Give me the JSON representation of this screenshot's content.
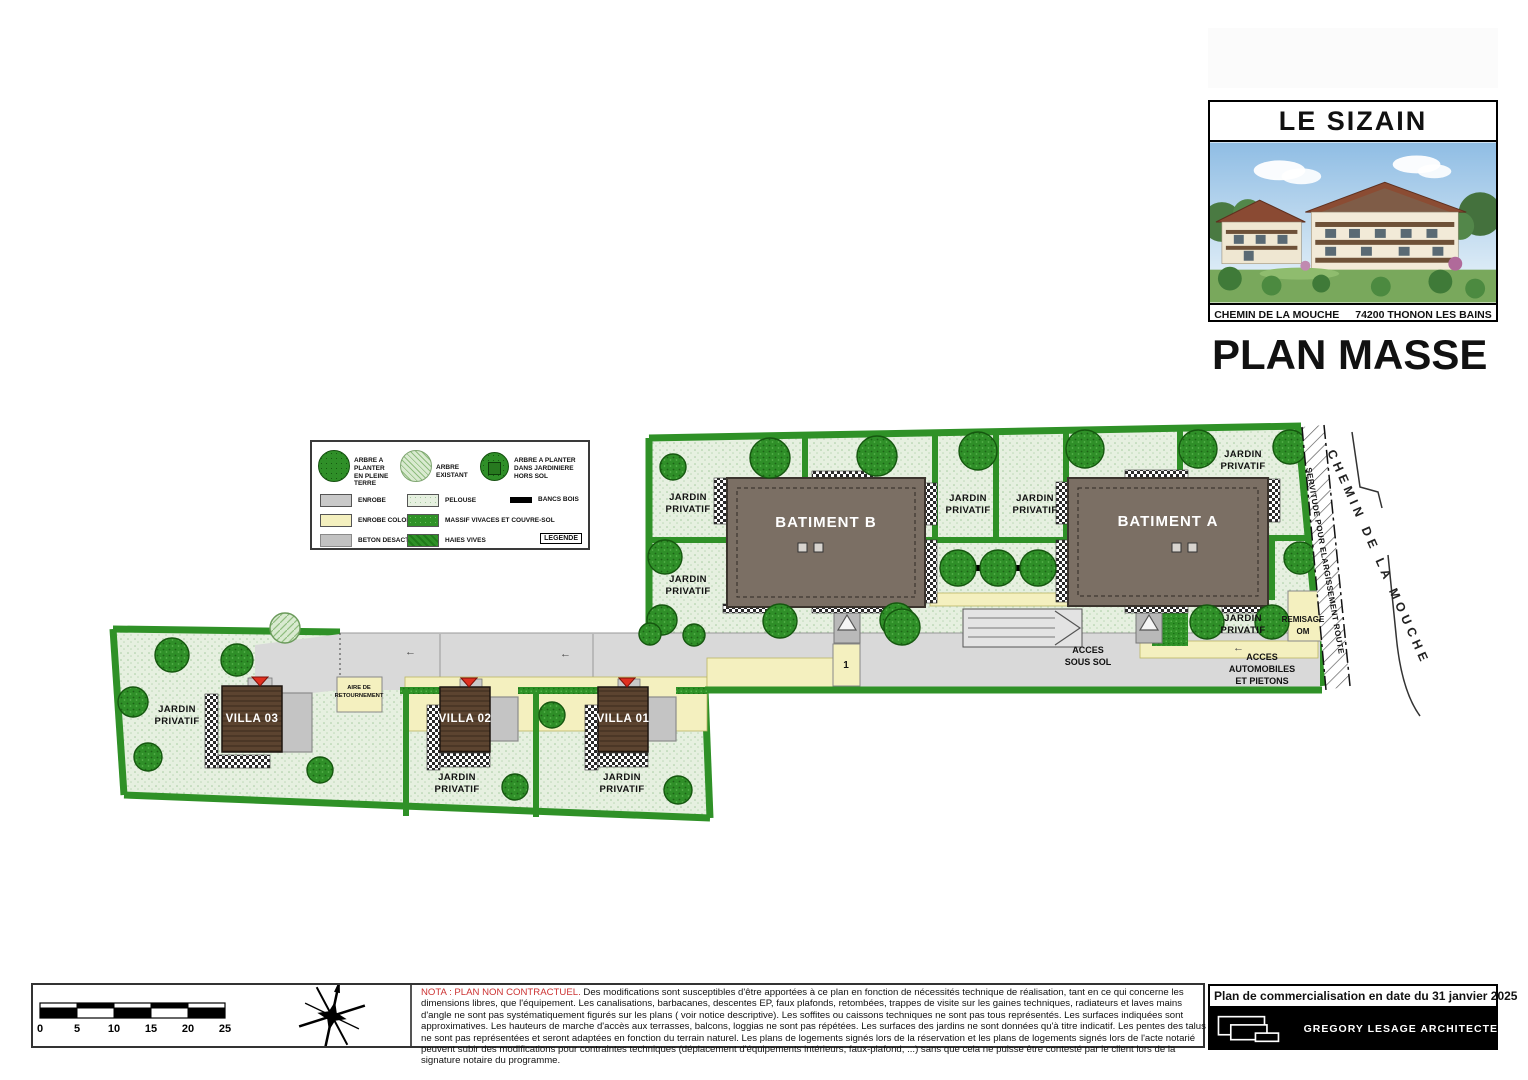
{
  "header": {
    "project_title": "LE SIZAIN",
    "address_street": "CHEMIN DE LA MOUCHE",
    "address_city": "74200 THONON LES BAINS",
    "drawing_title": "PLAN MASSE"
  },
  "legend": {
    "title": "LEGENDE",
    "tree_items": [
      {
        "line1": "ARBRE A PLANTER",
        "line2": "EN PLEINE TERRE"
      },
      {
        "line1": "ARBRE EXISTANT",
        "line2": ""
      },
      {
        "line1": "ARBRE A PLANTER",
        "line2": "DANS JARDINIERE HORS SOL"
      }
    ],
    "surface_items": [
      {
        "label": "ENROBE"
      },
      {
        "label": "ENROBE COLORE"
      },
      {
        "label": "BETON DESACTIVE"
      },
      {
        "label": "PELOUSE"
      },
      {
        "label": "MASSIF VIVACES ET COUVRE-SOL"
      },
      {
        "label": "HAIES VIVES"
      },
      {
        "label": "BANCS BOIS"
      }
    ]
  },
  "plan": {
    "batiment_a": "BATIMENT A",
    "batiment_b": "BATIMENT B",
    "villa_01": "VILLA 01",
    "villa_02": "VILLA 02",
    "villa_03": "VILLA 03",
    "jardin_l1": "JARDIN",
    "jardin_l2": "PRIVATIF",
    "acces_sous_sol_l1": "ACCES",
    "acces_sous_sol_l2": "SOUS SOL",
    "acces_auto_l1": "ACCES",
    "acces_auto_l2": "AUTOMOBILES",
    "acces_auto_l3": "ET PIETONS",
    "remisage_l1": "REMISAGE",
    "remisage_l2": "OM",
    "aire_l1": "AIRE DE",
    "aire_l2": "RETOURNEMENT",
    "servitude": "SERVITUDE POUR ELARGISSEMENT ROUTE",
    "road_name": "CHEMIN DE LA MOUCHE",
    "parking_spot": "1"
  },
  "scale_bar": {
    "labels": [
      "0",
      "5",
      "10",
      "15",
      "20",
      "25"
    ]
  },
  "nota": {
    "warning": "NOTA : PLAN NON CONTRACTUEL.",
    "body": "Des modifications sont susceptibles d'être apportées à ce plan en fonction de nécessités technique de réalisation, tant en ce qui concerne les dimensions libres, que l'équipement. Les canalisations, barbacanes, descentes EP, faux plafonds, retombées, trappes de visite sur les gaines techniques, radiateurs et laves mains d'angle ne sont pas systématiquement figurés sur les plans ( voir notice descriptive). Les soffites ou caissons techniques ne sont pas tous représentés. Les surfaces indiquées sont approximatives. Les hauteurs de marche d'accès aux terrasses, balcons, loggias ne sont pas répétées. Les surfaces des jardins ne sont données qu'à titre indicatif. Les pentes des talus ne sont pas représentées et seront adaptées en fonction du terrain naturel. Les plans de logements signés lors de la réservation et les plans de logements signés lors de l'acte notarié peuvent subir des modifications pour contraintes techniques (déplacement d'équipements intérieurs, faux-plafond, ...) sans que cela ne puisse être contesté par le client lors de la signature notaire du programme."
  },
  "footer": {
    "commercial_date": "Plan de commercialisation en date du 31 janvier 2025",
    "architect": "GREGORY LESAGE ARCHITECTE"
  },
  "colors": {
    "nota_red": "#cc3333",
    "building_brown": "#7b6f64",
    "villa_brown": "#5c4430",
    "pelouse_green": "#e6f0e0",
    "massif_green": "#2f9127",
    "tree_green": "#2f8f28",
    "enrobe_gray": "#d9d9d9",
    "enrobe_colore_yellow": "#f4f0bf"
  }
}
